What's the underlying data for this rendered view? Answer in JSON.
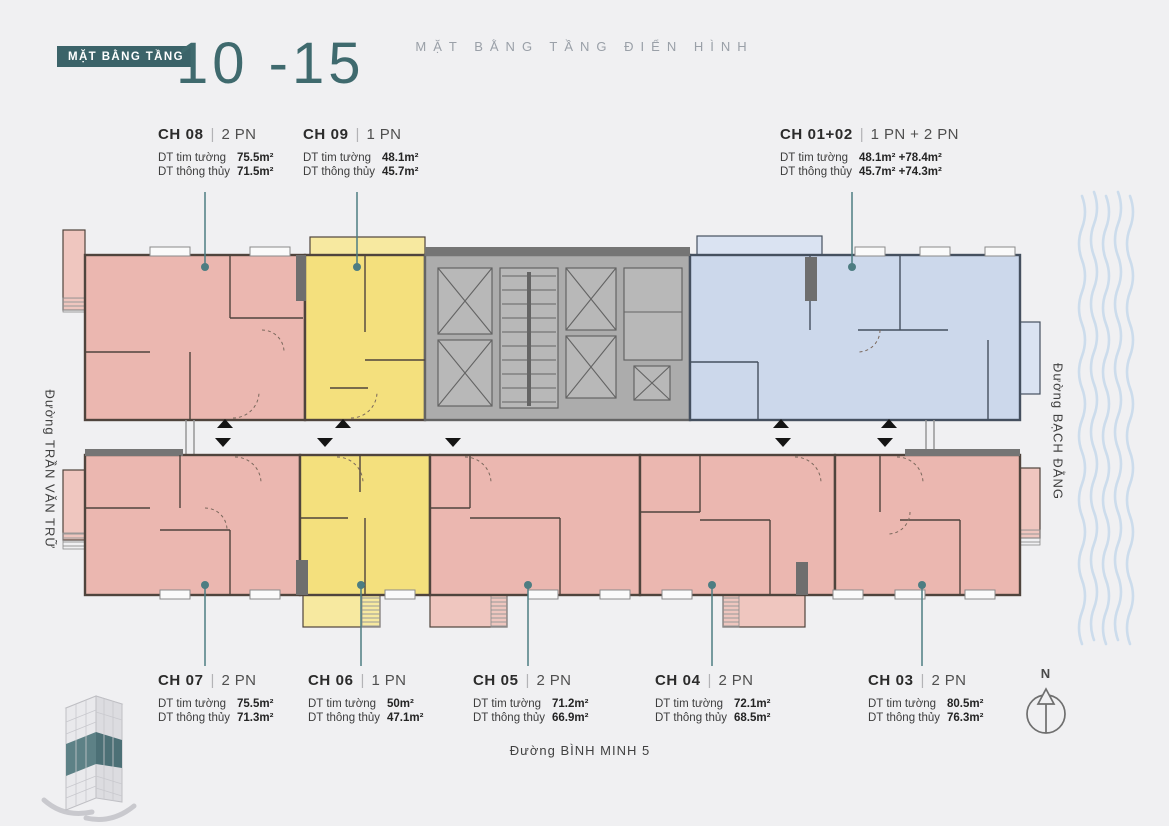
{
  "palette": {
    "bg": "#f0f0f2",
    "teal": "#3f6a6e",
    "badge-bg": "#3b6369",
    "subtitle-gray": "#9aa0a8",
    "text-dark": "#2b2b2b",
    "leader": "#4d7d82",
    "pink": "#ebb7b0",
    "pink-light": "#efc6bf",
    "yellow": "#f4e07d",
    "yellow-light": "#f7e9a0",
    "blue": "#ccd8eb",
    "blue-light": "#dae3f2",
    "core": "#acacac",
    "core-inner": "#b8b8b8",
    "core-dark": "#646464",
    "wall": "#4f443d",
    "wall-blue": "#45505f",
    "wave": "#ccdcec",
    "dark-bar": "#757575"
  },
  "header": {
    "badge": "MẶT BẰNG TẦNG",
    "floors": "10 -15",
    "subtitle": "MẶT BẰNG TẦNG ĐIỂN HÌNH"
  },
  "misc": {
    "sep": "|",
    "north": "N"
  },
  "area_labels": {
    "tim": "DT tim tường",
    "thong": "DT thông thủy"
  },
  "units": [
    {
      "id": "CH 08",
      "type": "2 PN",
      "tim": "75.5m²",
      "thong": "71.5m²"
    },
    {
      "id": "CH 09",
      "type": "1 PN",
      "tim": "48.1m²",
      "thong": "45.7m²"
    },
    {
      "id": "CH 01+02",
      "type": "1 PN + 2 PN",
      "tim": "48.1m² +78.4m²",
      "thong": "45.7m² +74.3m²"
    },
    {
      "id": "CH 07",
      "type": "2 PN",
      "tim": "75.5m²",
      "thong": "71.3m²"
    },
    {
      "id": "CH 06",
      "type": "1 PN",
      "tim": "50m²",
      "thong": "47.1m²"
    },
    {
      "id": "CH 05",
      "type": "2 PN",
      "tim": "71.2m²",
      "thong": "66.9m²"
    },
    {
      "id": "CH 04",
      "type": "2 PN",
      "tim": "72.1m²",
      "thong": "68.5m²"
    },
    {
      "id": "CH 03",
      "type": "2 PN",
      "tim": "80.5m²",
      "thong": "76.3m²"
    }
  ],
  "streets": {
    "left": "Đường TRẦN VĂN TRỮ",
    "right": "Đường BẠCH ĐẰNG",
    "bottom": "Đường BÌNH MINH 5"
  }
}
